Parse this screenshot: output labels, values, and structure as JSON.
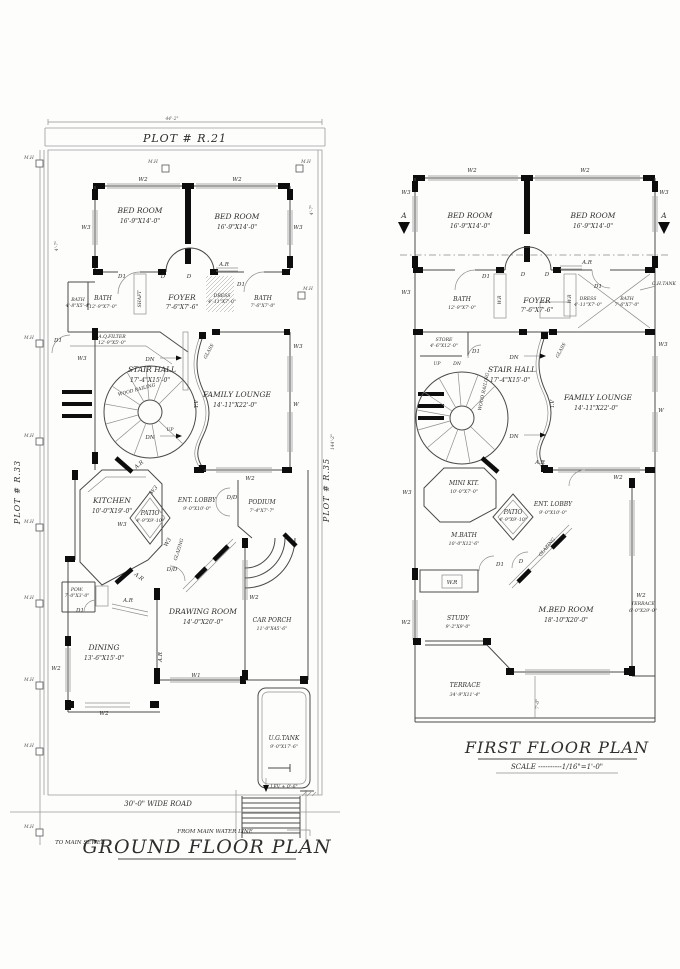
{
  "ground": {
    "top_dim": "44'-2\"",
    "plot_top": "PLOT # R.21",
    "plot_left": "PLOT # R.33",
    "plot_right": "PLOT # R.35",
    "side_dim": "144'-2\"",
    "corner_dim": "4'-7\"",
    "title": "GROUND FLOOR PLAN",
    "road": "30'-0\" WIDE ROAD",
    "water": "FROM MAIN WATER LINE",
    "sewer": "TO MAIN SEWER",
    "lev": "LEV + 0'-6\"",
    "rooms": {
      "bed1": {
        "name": "BED ROOM",
        "dim": "16'-9\"X14'-0\""
      },
      "bed2": {
        "name": "BED ROOM",
        "dim": "16'-9\"X14'-0\""
      },
      "bath1": {
        "name": "BATH",
        "dim": "12'-9\"X7'-0\""
      },
      "bathsm": {
        "name": "BATH",
        "dim": "4'-8\"X5'-4\""
      },
      "foyer": {
        "name": "FOYER",
        "dim": "7'-6\"X7'-6\""
      },
      "dress": {
        "name": "DRESS",
        "dim": "4'-11\"X7'-0\""
      },
      "bath2": {
        "name": "BATH",
        "dim": "7'-6\"X7'-0\""
      },
      "filter": {
        "name": "A.Q.FILTER",
        "dim": "12'-9\"X5'-0\""
      },
      "stair": {
        "name": "STAIR HALL",
        "dim": "17'-4\"X15'-0\""
      },
      "lounge": {
        "name": "FAMILY LOUNGE",
        "dim": "14'-11\"X22'-0\""
      },
      "kitchen": {
        "name": "KITCHEN",
        "dim": "10'-0\"X19'-0\""
      },
      "patio": {
        "name": "PATIO",
        "dim": "4'-9\"X9'-10\""
      },
      "lobby": {
        "name": "ENT. LOBBY",
        "dim": "9'-0\"X10'-0\""
      },
      "podium": {
        "name": "PODIUM",
        "dim": "7'-4\"X7'-7\""
      },
      "pow": {
        "name": "POW.",
        "dim": "7'-0\"X3'-0\""
      },
      "drawing": {
        "name": "DRAWING ROOM",
        "dim": "14'-0\"X20'-0\""
      },
      "porch": {
        "name": "CAR PORCH",
        "dim": "11'-0\"X45'-6\""
      },
      "dining": {
        "name": "DINING",
        "dim": "13'-6\"X15'-0\""
      },
      "tank": {
        "name": "U.G.TANK",
        "dim": "9'-0\"X17'-6\""
      }
    }
  },
  "first": {
    "title": "FIRST FLOOR PLAN",
    "scale": "SCALE ----------1/16\"=1'-0\"",
    "ohtank": "O.H.TANK",
    "section": "A",
    "bottom_dim": "7'-0\"",
    "rooms": {
      "bed1": {
        "name": "BED ROOM",
        "dim": "16'-9\"X14'-0\""
      },
      "bed2": {
        "name": "BED ROOM",
        "dim": "16'-9\"X14'-0\""
      },
      "bath1": {
        "name": "BATH",
        "dim": "12'-9\"X7'-0\""
      },
      "foyer": {
        "name": "FOYER",
        "dim": "7'-6\"X7'-6\""
      },
      "dress": {
        "name": "DRESS",
        "dim": "4'-11\"X7'-0\""
      },
      "bath2": {
        "name": "BATH",
        "dim": "7'-6\"X7'-0\""
      },
      "store": {
        "name": "STORE",
        "dim": "4'-6\"X12'-0\""
      },
      "stair": {
        "name": "STAIR HALL",
        "dim": "17'-4\"X15'-0\""
      },
      "lounge": {
        "name": "FAMILY LOUNGE",
        "dim": "14'-11\"X22'-0\""
      },
      "minikit": {
        "name": "MINI KIT.",
        "dim": "10'-0\"X7'-0\""
      },
      "patio": {
        "name": "PATIO",
        "dim": "4'-9\"X9'-10\""
      },
      "lobby": {
        "name": "ENT. LOBBY",
        "dim": "9'-0\"X10'-0\""
      },
      "mbath": {
        "name": "M.BATH",
        "dim": "10'-0\"X12'-6\""
      },
      "study": {
        "name": "STUDY",
        "dim": "9'-2\"X9'-0\""
      },
      "mbed": {
        "name": "M.BED ROOM",
        "dim": "18'-10\"X20'-0\""
      },
      "terrside": {
        "name": "TERRACE",
        "dim": "6'-0\"X29'-0\""
      },
      "terrbot": {
        "name": "TERRACE",
        "dim": "34'-9\"X11'-4\""
      }
    }
  },
  "markers": {
    "mh": "M.H",
    "w": "W",
    "w1": "W1",
    "w2": "W2",
    "w3": "W3",
    "d": "D",
    "d1": "D1",
    "dd": "D/D",
    "ar": "A.R",
    "dn": "DN",
    "up": "UP",
    "tv": "T.V",
    "glass": "GLASS",
    "glazing": "GLAZING",
    "wood_railing": "WOOD RAILING",
    "wr": "W.R",
    "shaft": "SHAFT"
  }
}
